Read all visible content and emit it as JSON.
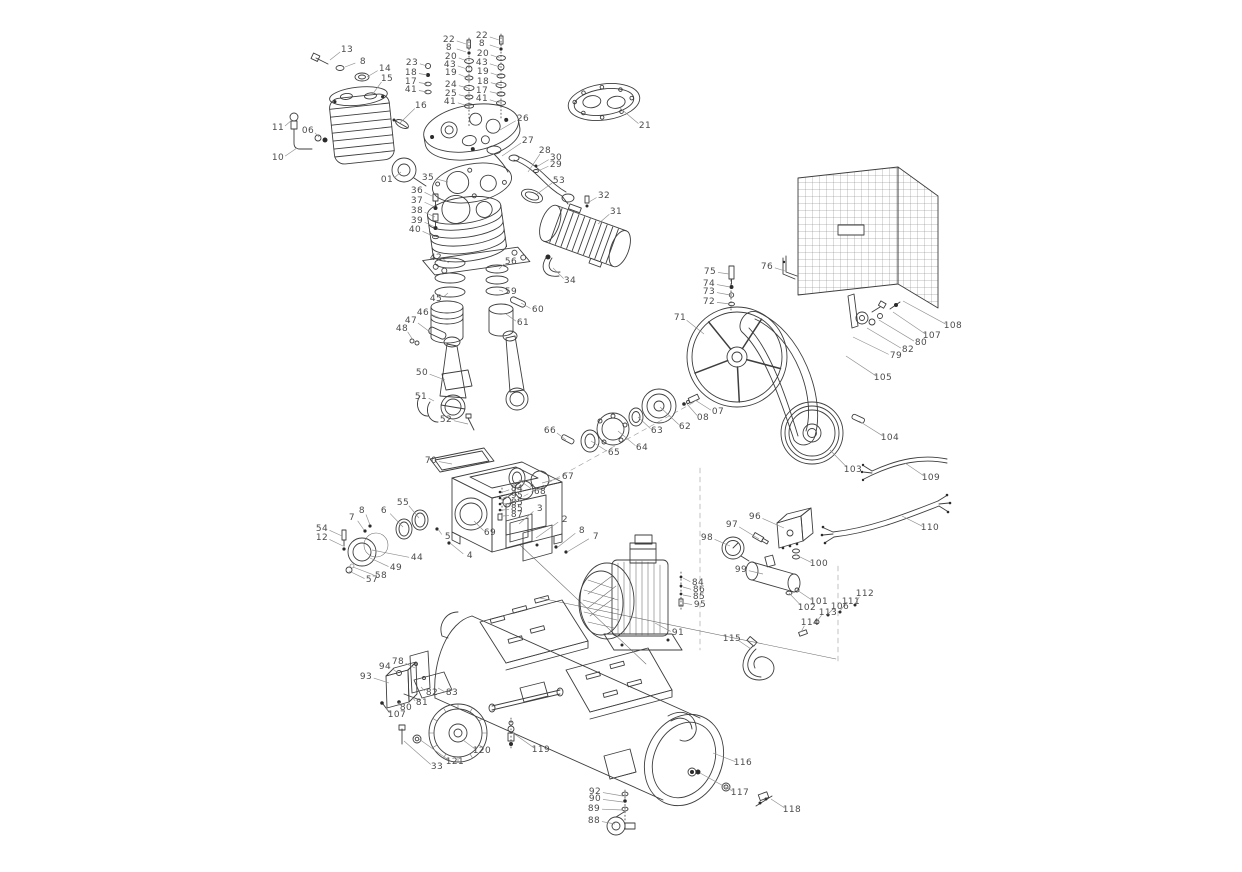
{
  "diagram": {
    "callouts": [
      {
        "label": "13",
        "x": 347,
        "y": 50,
        "tx": 330,
        "ty": 60
      },
      {
        "label": "8",
        "x": 363,
        "y": 62,
        "tx": 345,
        "ty": 67
      },
      {
        "label": "14",
        "x": 385,
        "y": 69,
        "tx": 367,
        "ty": 77
      },
      {
        "label": "15",
        "x": 387,
        "y": 79,
        "tx": 372,
        "ty": 95
      },
      {
        "label": "16",
        "x": 421,
        "y": 106,
        "tx": 400,
        "ty": 123
      },
      {
        "label": "11",
        "x": 278,
        "y": 128,
        "tx": 292,
        "ty": 120
      },
      {
        "label": "06",
        "x": 308,
        "y": 131,
        "tx": 319,
        "ty": 137
      },
      {
        "label": "10",
        "x": 278,
        "y": 158,
        "tx": 297,
        "ty": 148
      },
      {
        "label": "23",
        "x": 412,
        "y": 63,
        "tx": 427,
        "ty": 66
      },
      {
        "label": "18",
        "x": 411,
        "y": 73,
        "tx": 427,
        "ty": 75
      },
      {
        "label": "17",
        "x": 411,
        "y": 82,
        "tx": 427,
        "ty": 84
      },
      {
        "label": "41",
        "x": 411,
        "y": 90,
        "tx": 427,
        "ty": 92
      },
      {
        "label": "22",
        "x": 449,
        "y": 40,
        "tx": 466,
        "ty": 44
      },
      {
        "label": "8",
        "x": 449,
        "y": 48,
        "tx": 466,
        "ty": 52
      },
      {
        "label": "20",
        "x": 451,
        "y": 57,
        "tx": 467,
        "ty": 61
      },
      {
        "label": "43",
        "x": 450,
        "y": 65,
        "tx": 467,
        "ty": 69
      },
      {
        "label": "19",
        "x": 451,
        "y": 73,
        "tx": 468,
        "ty": 78
      },
      {
        "label": "24",
        "x": 451,
        "y": 85,
        "tx": 468,
        "ty": 88
      },
      {
        "label": "25",
        "x": 451,
        "y": 94,
        "tx": 468,
        "ty": 97
      },
      {
        "label": "41",
        "x": 450,
        "y": 102,
        "tx": 468,
        "ty": 106
      },
      {
        "label": "22",
        "x": 482,
        "y": 36,
        "tx": 499,
        "ty": 40
      },
      {
        "label": "8",
        "x": 482,
        "y": 44,
        "tx": 499,
        "ty": 48
      },
      {
        "label": "20",
        "x": 483,
        "y": 54,
        "tx": 500,
        "ty": 58
      },
      {
        "label": "43",
        "x": 482,
        "y": 63,
        "tx": 500,
        "ty": 67
      },
      {
        "label": "19",
        "x": 483,
        "y": 72,
        "tx": 500,
        "ty": 76
      },
      {
        "label": "18",
        "x": 483,
        "y": 82,
        "tx": 500,
        "ty": 85
      },
      {
        "label": "17",
        "x": 482,
        "y": 91,
        "tx": 500,
        "ty": 94
      },
      {
        "label": "41",
        "x": 482,
        "y": 99,
        "tx": 500,
        "ty": 103
      },
      {
        "label": "26",
        "x": 523,
        "y": 119,
        "tx": 500,
        "ty": 130
      },
      {
        "label": "21",
        "x": 645,
        "y": 126,
        "tx": 620,
        "ty": 108
      },
      {
        "label": "27",
        "x": 528,
        "y": 141,
        "tx": 502,
        "ty": 156
      },
      {
        "label": "28",
        "x": 545,
        "y": 151,
        "tx": 528,
        "ty": 172
      },
      {
        "label": "30",
        "x": 556,
        "y": 158,
        "tx": 538,
        "ty": 166
      },
      {
        "label": "29",
        "x": 556,
        "y": 165,
        "tx": 538,
        "ty": 171
      },
      {
        "label": "53",
        "x": 559,
        "y": 181,
        "tx": 537,
        "ty": 194
      },
      {
        "label": "35",
        "x": 428,
        "y": 178,
        "tx": 448,
        "ty": 182
      },
      {
        "label": "01",
        "x": 387,
        "y": 180,
        "tx": 401,
        "ty": 172
      },
      {
        "label": "36",
        "x": 417,
        "y": 191,
        "tx": 434,
        "ty": 197
      },
      {
        "label": "37",
        "x": 417,
        "y": 201,
        "tx": 435,
        "ty": 207
      },
      {
        "label": "38",
        "x": 417,
        "y": 211,
        "tx": 435,
        "ty": 217
      },
      {
        "label": "39",
        "x": 417,
        "y": 221,
        "tx": 435,
        "ty": 227
      },
      {
        "label": "40",
        "x": 415,
        "y": 230,
        "tx": 435,
        "ty": 237
      },
      {
        "label": "32",
        "x": 604,
        "y": 196,
        "tx": 589,
        "ty": 202
      },
      {
        "label": "31",
        "x": 616,
        "y": 212,
        "tx": 598,
        "ty": 224
      },
      {
        "label": "34",
        "x": 570,
        "y": 281,
        "tx": 553,
        "ty": 268
      },
      {
        "label": "42",
        "x": 436,
        "y": 258,
        "tx": 449,
        "ty": 263
      },
      {
        "label": "56",
        "x": 511,
        "y": 262,
        "tx": 499,
        "ty": 269
      },
      {
        "label": "45",
        "x": 436,
        "y": 299,
        "tx": 448,
        "ty": 293
      },
      {
        "label": "59",
        "x": 511,
        "y": 292,
        "tx": 499,
        "ty": 290
      },
      {
        "label": "46",
        "x": 423,
        "y": 313,
        "tx": 440,
        "ty": 318
      },
      {
        "label": "47",
        "x": 411,
        "y": 321,
        "tx": 430,
        "ty": 332
      },
      {
        "label": "48",
        "x": 402,
        "y": 329,
        "tx": 413,
        "ty": 340
      },
      {
        "label": "60",
        "x": 538,
        "y": 310,
        "tx": 521,
        "ty": 303
      },
      {
        "label": "61",
        "x": 523,
        "y": 323,
        "tx": 506,
        "ty": 314
      },
      {
        "label": "50",
        "x": 422,
        "y": 373,
        "tx": 445,
        "ty": 380
      },
      {
        "label": "51",
        "x": 421,
        "y": 397,
        "tx": 434,
        "ty": 401
      },
      {
        "label": "52",
        "x": 446,
        "y": 420,
        "tx": 468,
        "ty": 424
      },
      {
        "label": "66",
        "x": 550,
        "y": 431,
        "tx": 566,
        "ty": 440
      },
      {
        "label": "65",
        "x": 614,
        "y": 453,
        "tx": 591,
        "ty": 441
      },
      {
        "label": "64",
        "x": 642,
        "y": 448,
        "tx": 618,
        "ty": 431
      },
      {
        "label": "63",
        "x": 657,
        "y": 431,
        "tx": 638,
        "ty": 417
      },
      {
        "label": "62",
        "x": 685,
        "y": 427,
        "tx": 660,
        "ty": 407
      },
      {
        "label": "08",
        "x": 703,
        "y": 418,
        "tx": 687,
        "ty": 404
      },
      {
        "label": "07",
        "x": 718,
        "y": 412,
        "tx": 695,
        "ty": 400
      },
      {
        "label": "67",
        "x": 568,
        "y": 477,
        "tx": 542,
        "ty": 483
      },
      {
        "label": "68",
        "x": 540,
        "y": 492,
        "tx": 519,
        "ty": 480
      },
      {
        "label": "70",
        "x": 431,
        "y": 461,
        "tx": 452,
        "ty": 464
      },
      {
        "label": "55",
        "x": 403,
        "y": 503,
        "tx": 419,
        "ty": 518
      },
      {
        "label": "6",
        "x": 384,
        "y": 511,
        "tx": 403,
        "ty": 527
      },
      {
        "label": "8",
        "x": 362,
        "y": 511,
        "tx": 370,
        "ty": 525
      },
      {
        "label": "7",
        "x": 352,
        "y": 518,
        "tx": 364,
        "ty": 530
      },
      {
        "label": "54",
        "x": 322,
        "y": 529,
        "tx": 342,
        "ty": 536
      },
      {
        "label": "12",
        "x": 322,
        "y": 538,
        "tx": 343,
        "ty": 546
      },
      {
        "label": "69",
        "x": 490,
        "y": 533,
        "tx": 474,
        "ty": 521
      },
      {
        "label": "5",
        "x": 448,
        "y": 537,
        "tx": 438,
        "ty": 529
      },
      {
        "label": "4",
        "x": 470,
        "y": 556,
        "tx": 450,
        "ty": 543
      },
      {
        "label": "44",
        "x": 417,
        "y": 558,
        "tx": 372,
        "ty": 550
      },
      {
        "label": "49",
        "x": 396,
        "y": 568,
        "tx": 370,
        "ty": 558
      },
      {
        "label": "58",
        "x": 381,
        "y": 576,
        "tx": 353,
        "ty": 567
      },
      {
        "label": "57",
        "x": 372,
        "y": 580,
        "tx": 349,
        "ty": 571
      },
      {
        "label": "3",
        "x": 540,
        "y": 509,
        "tx": 519,
        "ty": 524
      },
      {
        "label": "2",
        "x": 565,
        "y": 520,
        "tx": 536,
        "ty": 538
      },
      {
        "label": "8",
        "x": 582,
        "y": 531,
        "tx": 558,
        "ty": 547
      },
      {
        "label": "7",
        "x": 596,
        "y": 537,
        "tx": 567,
        "ty": 552
      },
      {
        "label": "84",
        "x": 517,
        "y": 489,
        "tx": 503,
        "ty": 492
      },
      {
        "label": "95",
        "x": 517,
        "y": 496,
        "tx": 503,
        "ty": 498
      },
      {
        "label": "85",
        "x": 517,
        "y": 503,
        "tx": 503,
        "ty": 504
      },
      {
        "label": "85",
        "x": 517,
        "y": 509,
        "tx": 503,
        "ty": 510
      },
      {
        "label": "87",
        "x": 517,
        "y": 515,
        "tx": 503,
        "ty": 516
      },
      {
        "label": "71",
        "x": 680,
        "y": 318,
        "tx": 704,
        "ty": 334
      },
      {
        "label": "75",
        "x": 710,
        "y": 272,
        "tx": 729,
        "ty": 274
      },
      {
        "label": "74",
        "x": 709,
        "y": 284,
        "tx": 730,
        "ty": 287
      },
      {
        "label": "73",
        "x": 709,
        "y": 292,
        "tx": 730,
        "ty": 295
      },
      {
        "label": "72",
        "x": 709,
        "y": 302,
        "tx": 730,
        "ty": 304
      },
      {
        "label": "76",
        "x": 767,
        "y": 267,
        "tx": 785,
        "ty": 271
      },
      {
        "label": "105",
        "x": 883,
        "y": 378,
        "tx": 846,
        "ty": 356
      },
      {
        "label": "108",
        "x": 953,
        "y": 326,
        "tx": 903,
        "ty": 301
      },
      {
        "label": "107",
        "x": 932,
        "y": 336,
        "tx": 893,
        "ty": 312
      },
      {
        "label": "80",
        "x": 921,
        "y": 343,
        "tx": 879,
        "ty": 320
      },
      {
        "label": "82",
        "x": 908,
        "y": 350,
        "tx": 867,
        "ty": 328
      },
      {
        "label": "79",
        "x": 896,
        "y": 356,
        "tx": 853,
        "ty": 337
      },
      {
        "label": "104",
        "x": 890,
        "y": 438,
        "tx": 859,
        "ty": 421
      },
      {
        "label": "103",
        "x": 853,
        "y": 470,
        "tx": 830,
        "ty": 450
      },
      {
        "label": "109",
        "x": 931,
        "y": 478,
        "tx": 905,
        "ty": 463
      },
      {
        "label": "110",
        "x": 930,
        "y": 528,
        "tx": 902,
        "ty": 516
      },
      {
        "label": "96",
        "x": 755,
        "y": 517,
        "tx": 784,
        "ty": 528
      },
      {
        "label": "97",
        "x": 732,
        "y": 525,
        "tx": 759,
        "ty": 539
      },
      {
        "label": "98",
        "x": 707,
        "y": 538,
        "tx": 730,
        "ty": 546
      },
      {
        "label": "99",
        "x": 741,
        "y": 570,
        "tx": 763,
        "ty": 574
      },
      {
        "label": "100",
        "x": 819,
        "y": 564,
        "tx": 796,
        "ty": 555
      },
      {
        "label": "101",
        "x": 819,
        "y": 602,
        "tx": 797,
        "ty": 590
      },
      {
        "label": "102",
        "x": 807,
        "y": 608,
        "tx": 789,
        "ty": 593
      },
      {
        "label": "106",
        "x": 840,
        "y": 607,
        "tx": 828,
        "ty": 614
      },
      {
        "label": "111",
        "x": 851,
        "y": 602,
        "tx": 840,
        "ty": 611
      },
      {
        "label": "112",
        "x": 865,
        "y": 594,
        "tx": 855,
        "ty": 604
      },
      {
        "label": "113",
        "x": 828,
        "y": 613,
        "tx": 817,
        "ty": 621
      },
      {
        "label": "114",
        "x": 810,
        "y": 623,
        "tx": 801,
        "ty": 632
      },
      {
        "label": "115",
        "x": 732,
        "y": 639,
        "tx": 751,
        "ty": 649
      },
      {
        "label": "91",
        "x": 678,
        "y": 633,
        "tx": 655,
        "ty": 623
      },
      {
        "label": "84",
        "x": 698,
        "y": 583,
        "tx": 683,
        "ty": 578
      },
      {
        "label": "86",
        "x": 699,
        "y": 590,
        "tx": 683,
        "ty": 587
      },
      {
        "label": "85",
        "x": 699,
        "y": 597,
        "tx": 683,
        "ty": 595
      },
      {
        "label": "95",
        "x": 700,
        "y": 605,
        "tx": 683,
        "ty": 603
      },
      {
        "label": "78",
        "x": 398,
        "y": 662,
        "tx": 415,
        "ty": 668
      },
      {
        "label": "94",
        "x": 385,
        "y": 667,
        "tx": 398,
        "ty": 673
      },
      {
        "label": "93",
        "x": 366,
        "y": 677,
        "tx": 389,
        "ty": 683
      },
      {
        "label": "82",
        "x": 432,
        "y": 693,
        "tx": 421,
        "ty": 687
      },
      {
        "label": "83",
        "x": 452,
        "y": 693,
        "tx": 438,
        "ty": 688
      },
      {
        "label": "81",
        "x": 422,
        "y": 703,
        "tx": 412,
        "ty": 697
      },
      {
        "label": "80",
        "x": 406,
        "y": 708,
        "tx": 399,
        "ty": 702
      },
      {
        "label": "107",
        "x": 397,
        "y": 715,
        "tx": 386,
        "ty": 708
      },
      {
        "label": "120",
        "x": 482,
        "y": 751,
        "tx": 463,
        "ty": 740
      },
      {
        "label": "121",
        "x": 455,
        "y": 762,
        "tx": 419,
        "ty": 739
      },
      {
        "label": "33",
        "x": 437,
        "y": 767,
        "tx": 404,
        "ty": 741
      },
      {
        "label": "119",
        "x": 541,
        "y": 750,
        "tx": 513,
        "ty": 733
      },
      {
        "label": "116",
        "x": 743,
        "y": 763,
        "tx": 713,
        "ty": 753
      },
      {
        "label": "117",
        "x": 740,
        "y": 793,
        "tx": 700,
        "ty": 773
      },
      {
        "label": "118",
        "x": 792,
        "y": 810,
        "tx": 771,
        "ty": 799
      },
      {
        "label": "92",
        "x": 595,
        "y": 792,
        "tx": 623,
        "ty": 796
      },
      {
        "label": "90",
        "x": 595,
        "y": 799,
        "tx": 623,
        "ty": 802
      },
      {
        "label": "89",
        "x": 594,
        "y": 809,
        "tx": 623,
        "ty": 810
      },
      {
        "label": "88",
        "x": 594,
        "y": 821,
        "tx": 615,
        "ty": 824
      }
    ]
  }
}
